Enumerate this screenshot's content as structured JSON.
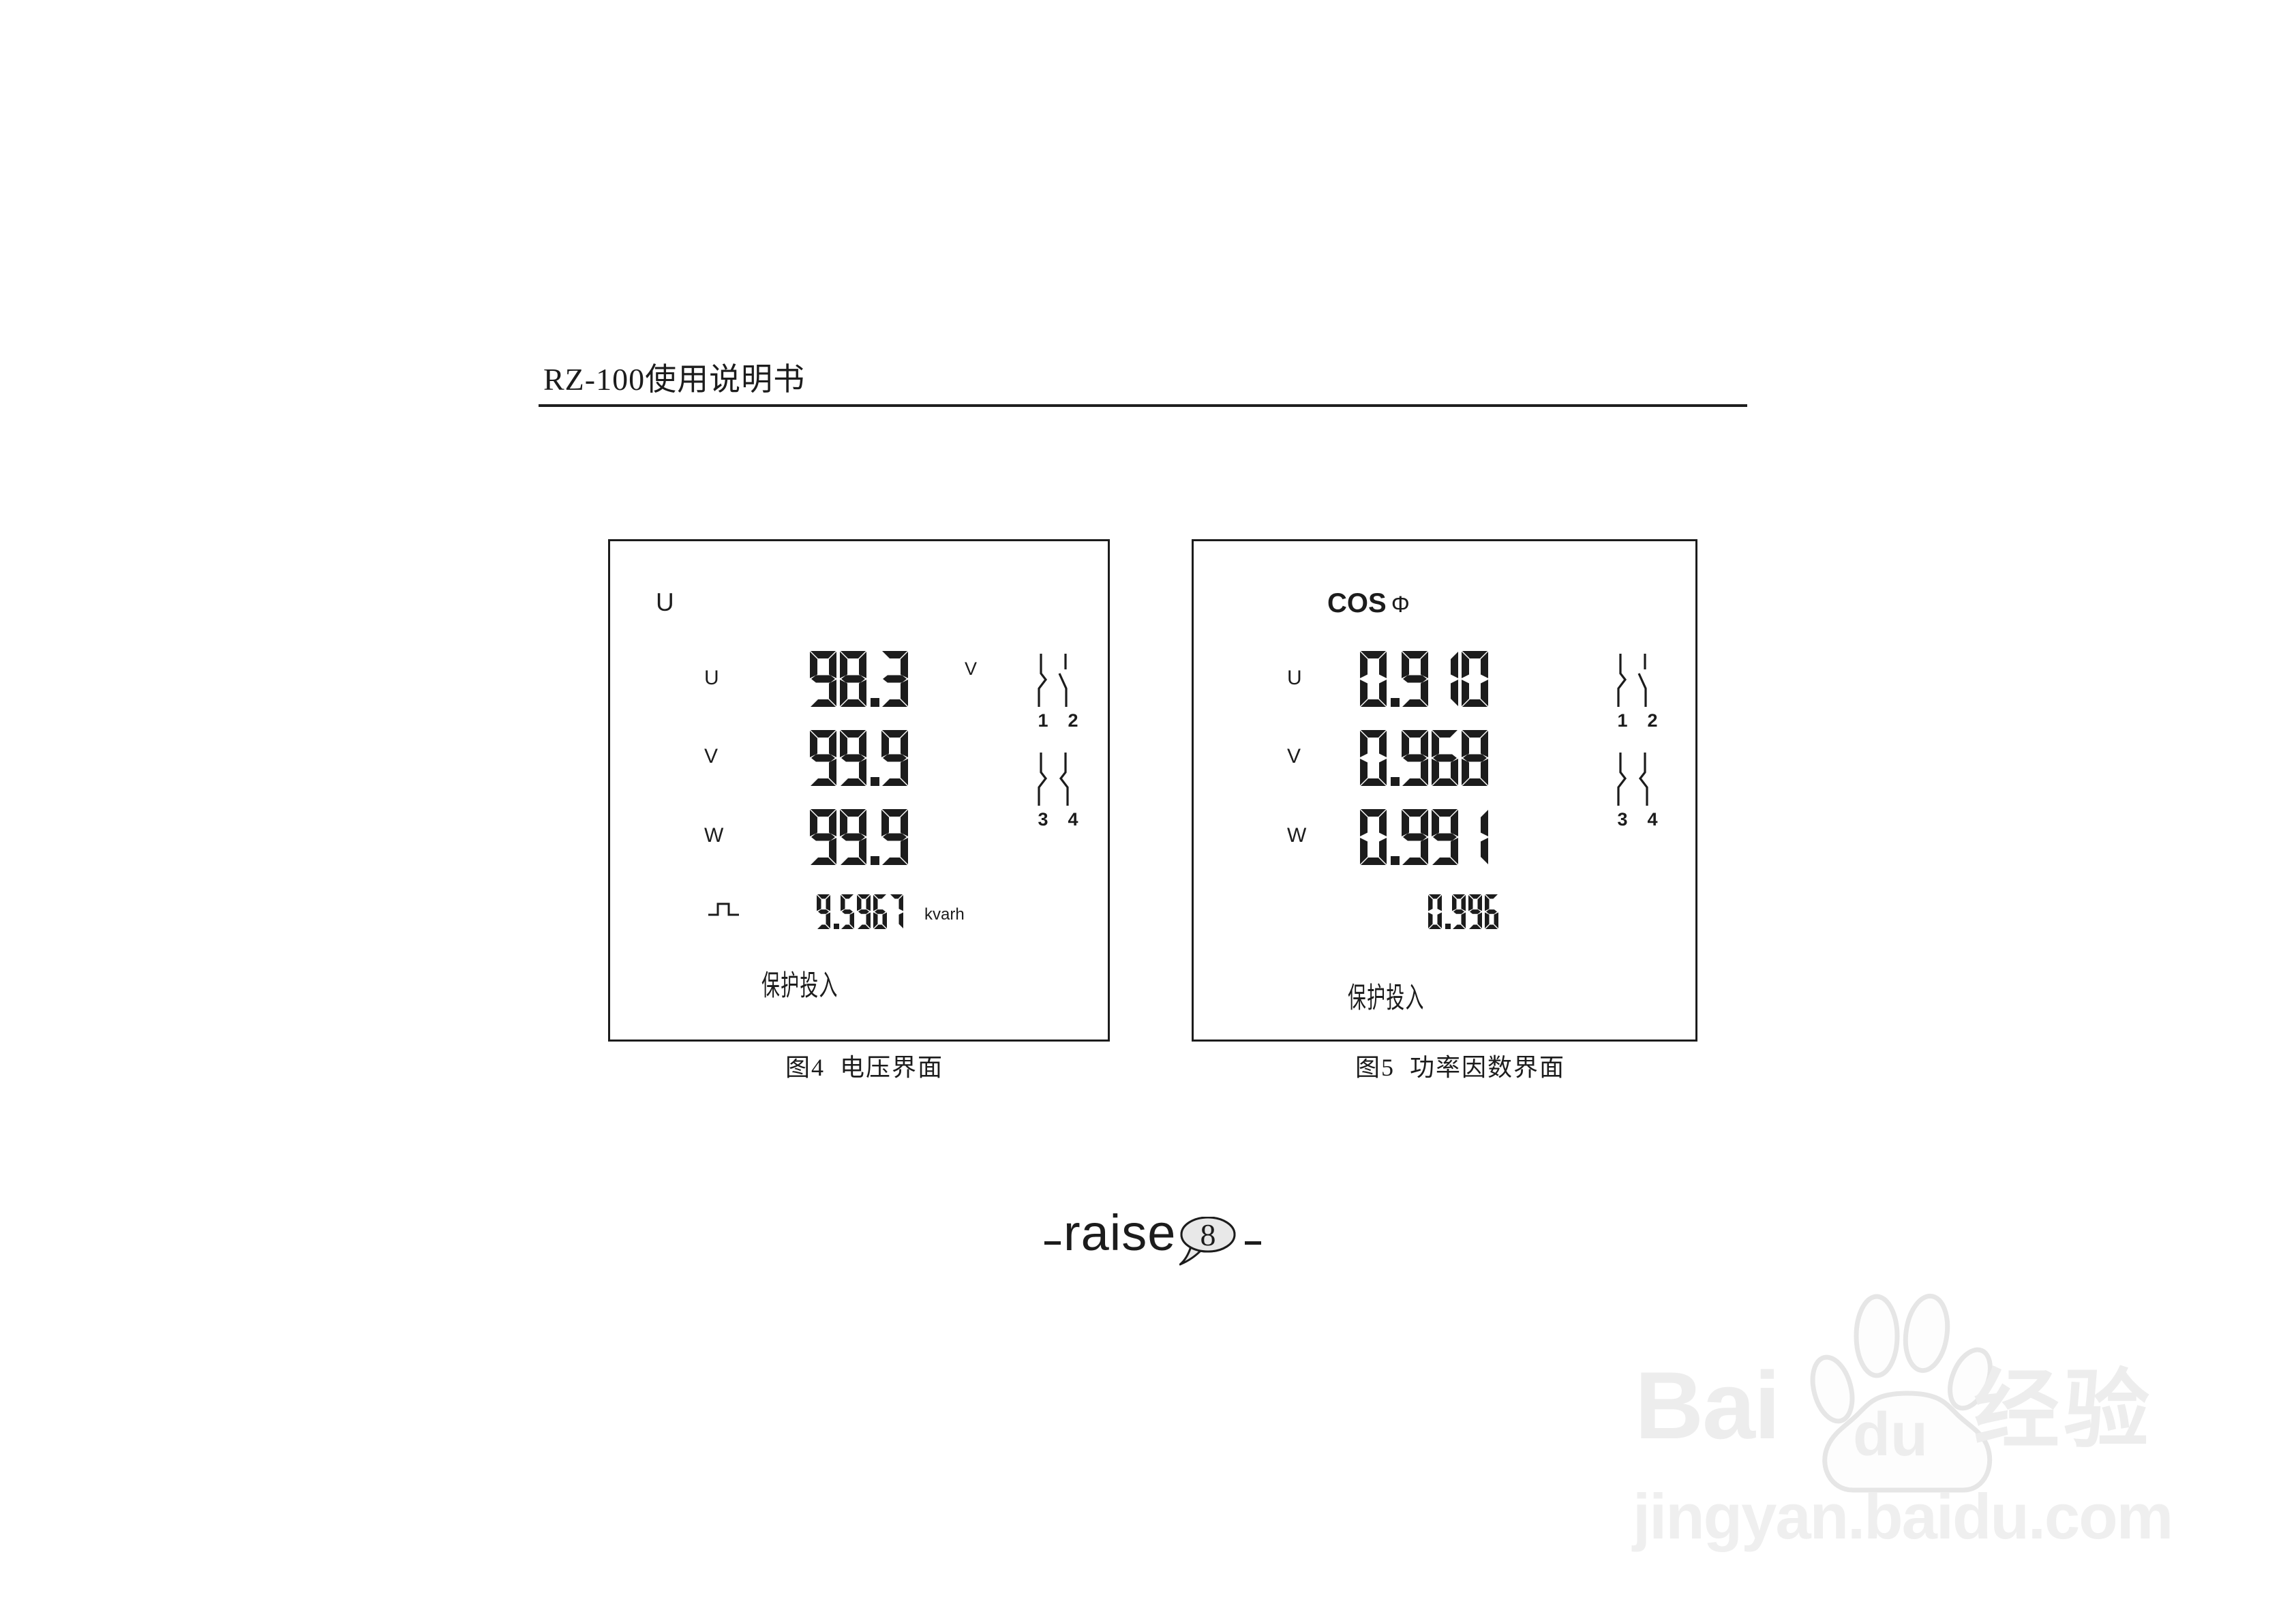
{
  "header": {
    "title": "RZ-100使用说明书"
  },
  "figure4": {
    "screen_label": "U",
    "rows": [
      {
        "phase": "U",
        "value": "98.3",
        "unit": "V"
      },
      {
        "phase": "V",
        "value": "99.9",
        "unit": ""
      },
      {
        "phase": "W",
        "value": "99.9",
        "unit": ""
      }
    ],
    "energy": {
      "value": "9.5967",
      "unit": "kvarh"
    },
    "status_text": "保护投入",
    "switch_labels": [
      "1",
      "2",
      "3",
      "4"
    ],
    "caption": "图4  电压界面"
  },
  "figure5": {
    "screen_label": "COS",
    "screen_label_symbol": "Φ",
    "rows": [
      {
        "phase": "U",
        "value": "0.910"
      },
      {
        "phase": "V",
        "value": "0.968"
      },
      {
        "phase": "W",
        "value": "0.991"
      }
    ],
    "avg_value": "0.996",
    "status_text": "保护投入",
    "switch_labels": [
      "1",
      "2",
      "3",
      "4"
    ],
    "caption": "图5  功率因数界面"
  },
  "footer": {
    "brand": "raise",
    "page_number": "8"
  },
  "watermark": {
    "brand_latin": "Bai",
    "brand_latin2": "du",
    "brand_cjk": "经验",
    "url": "jingyan.baidu.com"
  },
  "colors": {
    "ink": "#1c1c1c",
    "watermark": "#ededed",
    "bubble_fill": "#e8e8e8"
  }
}
